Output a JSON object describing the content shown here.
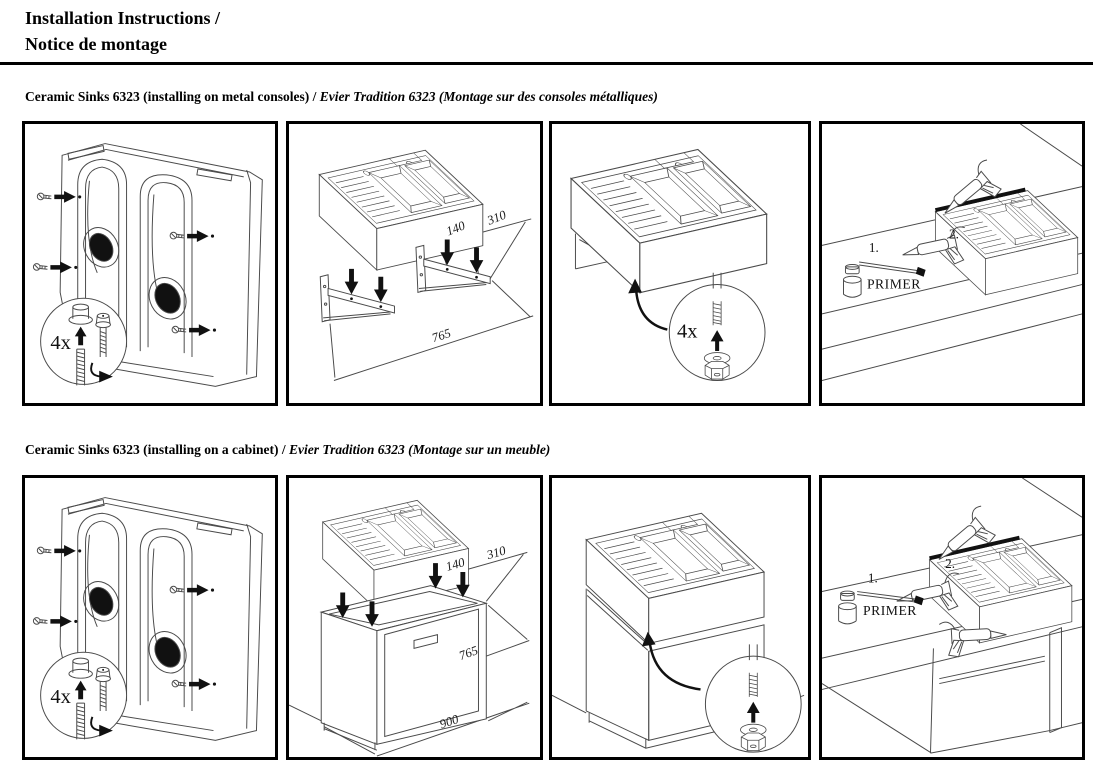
{
  "header": {
    "title_line1": "Installation Instructions /",
    "title_line2": "Notice de montage"
  },
  "colors": {
    "line": "#4a4a4a",
    "ink": "#111111",
    "paper": "#ffffff"
  },
  "sections": [
    {
      "id": "metal-consoles",
      "heading_en": "Ceramic Sinks 6323 (installing on metal consoles)",
      "heading_sep": " / ",
      "heading_fr": "Evier Tradition 6323 (Montage sur des consoles métalliques)",
      "panels": {
        "underside": {
          "qty": "4x"
        },
        "consoles": {
          "dim_140": "140",
          "dim_310": "310",
          "dim_765": "765"
        },
        "fasten": {
          "qty": "4x"
        },
        "seal": {
          "step_1": "1.",
          "step_2": "2.",
          "primer": "PRIMER"
        }
      }
    },
    {
      "id": "cabinet",
      "heading_en": "Ceramic Sinks 6323 (installing on a cabinet)",
      "heading_sep": " / ",
      "heading_fr": "Evier Tradition 6323 (Montage sur un meuble)",
      "panels": {
        "underside": {
          "qty": "4x"
        },
        "cabinet": {
          "dim_140": "140",
          "dim_310": "310",
          "dim_765": "765",
          "dim_900": "900"
        },
        "fasten": {},
        "seal": {
          "step_1": "1.",
          "step_2": "2.",
          "primer": "PRIMER"
        }
      }
    }
  ]
}
